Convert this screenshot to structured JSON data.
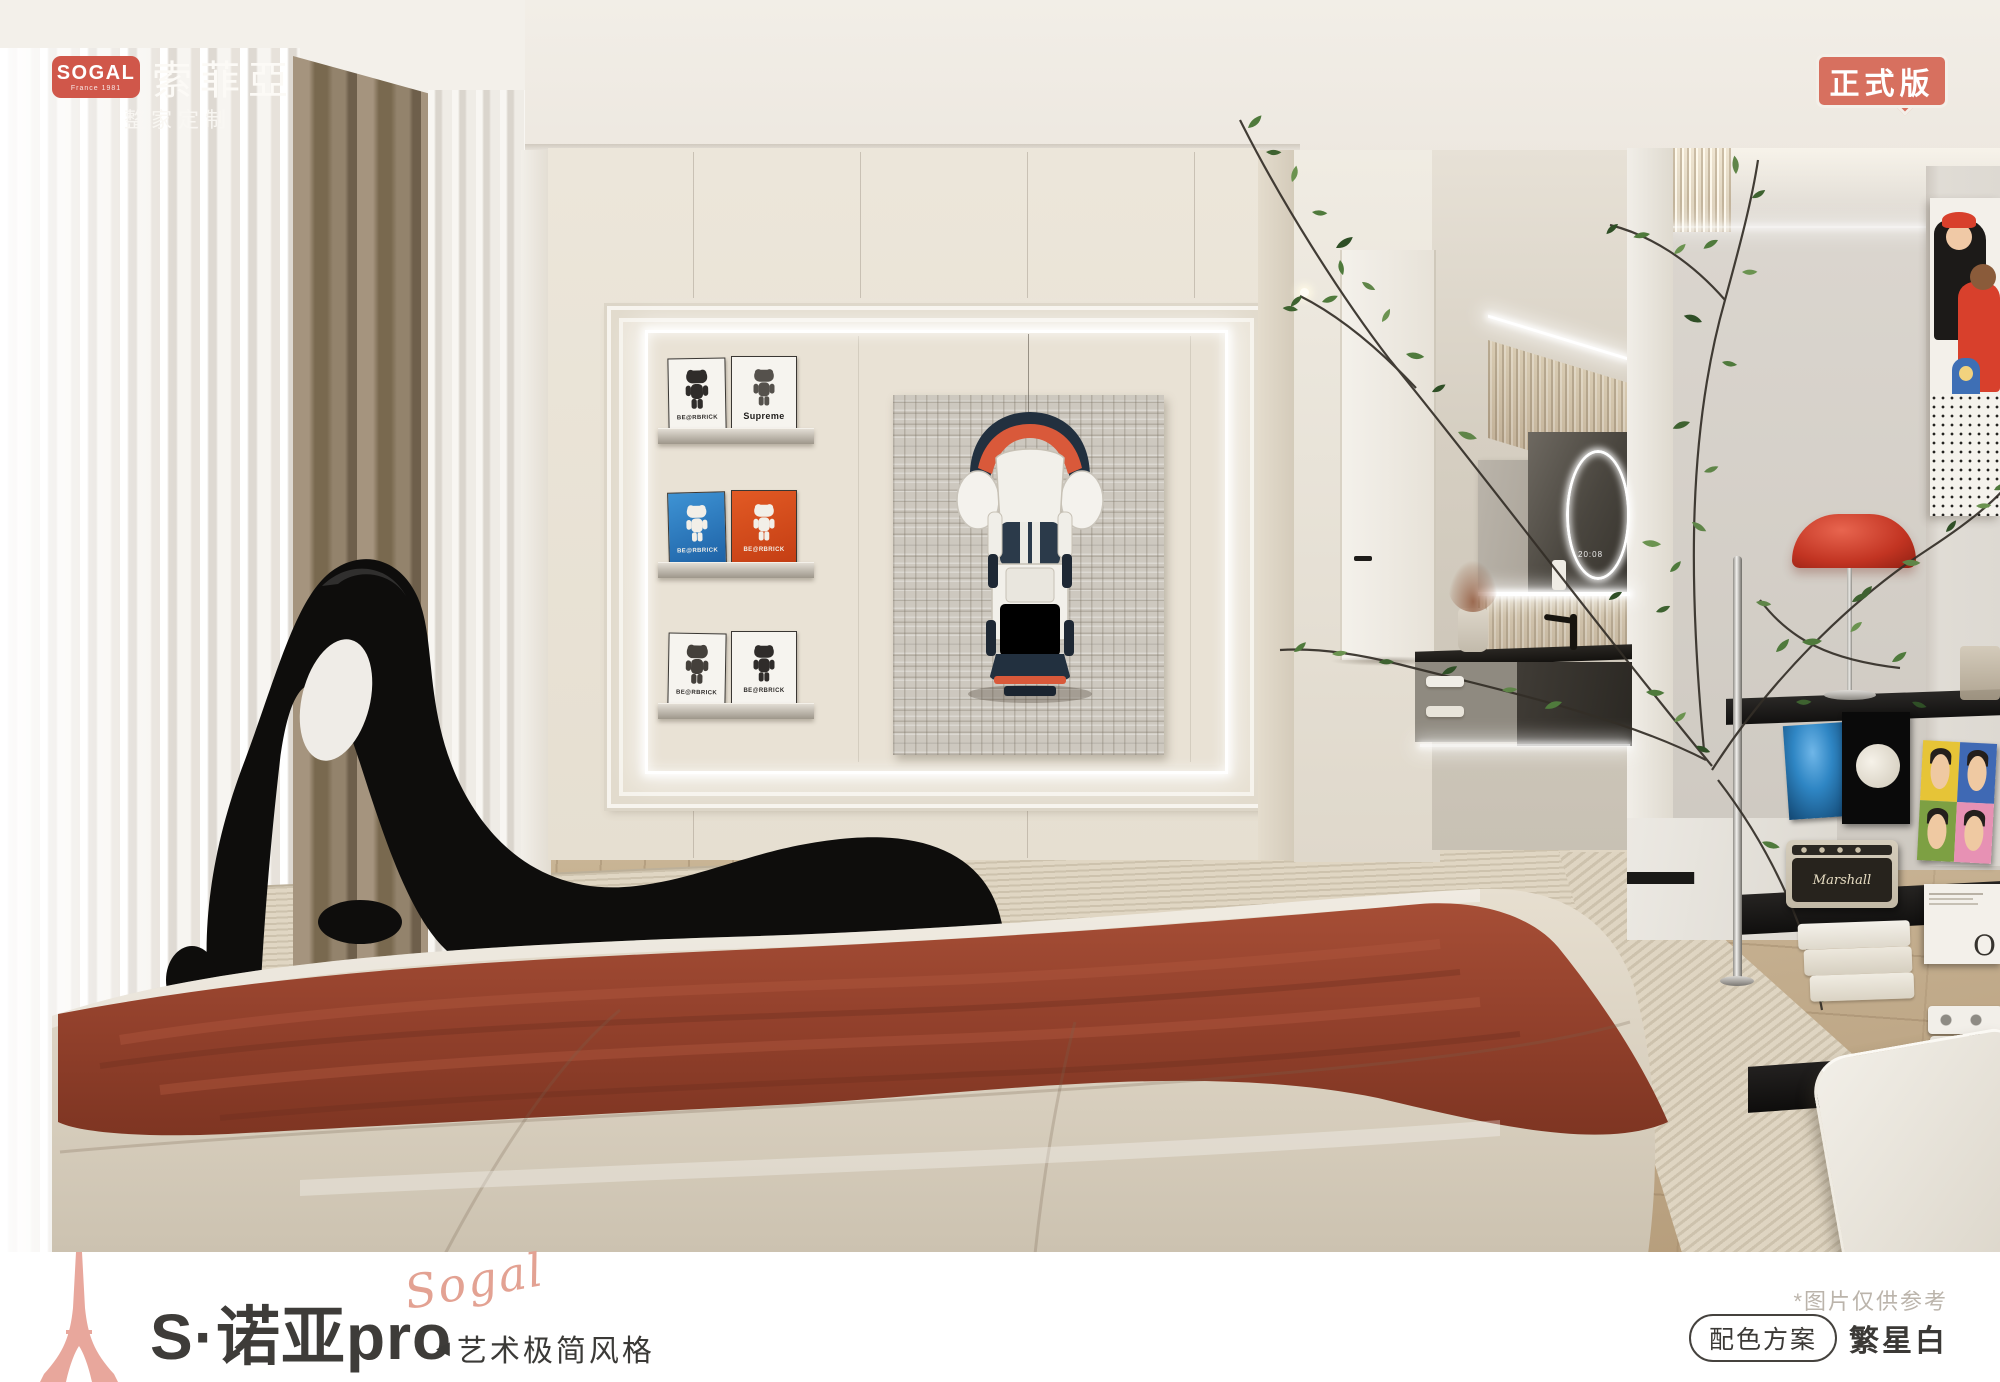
{
  "header": {
    "logo_primary": "SOGAL",
    "logo_secondary": "France 1981",
    "brand_cn": "索菲亞",
    "brand_tagline": "整家定制",
    "version_badge": "正式版"
  },
  "footer": {
    "series_title": "S·诺亚pro",
    "brand_script": "Sogal",
    "style_marker": "◀",
    "style_name": "艺术极简风格",
    "disclaimer": "*图片仅供参考",
    "scheme_label": "配色方案",
    "scheme_name": "繁星白"
  },
  "wall_display": {
    "book1_label": "BE@RBRICK",
    "book2_label": "Supreme",
    "book3_label": "BE@RBRICK",
    "book4_label": "BE@RBRICK",
    "book5_label": "BE@RBRICK",
    "book6_label": "BE@RBRICK"
  },
  "media_shelf": {
    "speaker_brand": "Marshall",
    "box_letter": "O"
  },
  "vanity": {
    "mirror_display": "20:08"
  },
  "colors": {
    "brand_red": "#D0574A",
    "badge_red": "#D7705F",
    "accent_pink": "#E3A293",
    "footer_text": "#3E3C39",
    "blanket_rust": "#96432F",
    "wall_cream": "#EAE3D7",
    "wood_floor": "#C5AF8F"
  }
}
